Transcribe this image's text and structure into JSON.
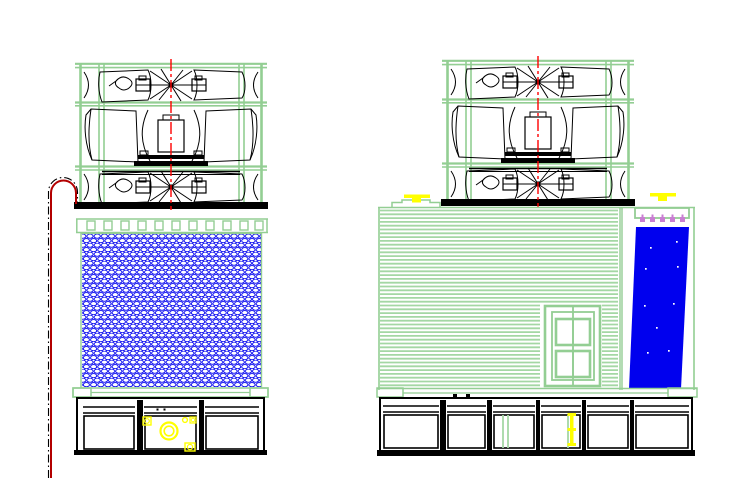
{
  "colors": {
    "green": "#93ce93",
    "louver": "#a4d7a4",
    "blue": "#0000ee",
    "red": "#ff0000",
    "pipe": "#b30000",
    "yellow": "#ffff00",
    "purple": "#c97fd2",
    "black": "#000000",
    "bg": "#ffffff"
  },
  "drawing": {
    "views": [
      {
        "id": "front-elevation",
        "fan_tiers": 3,
        "base_bays": 3,
        "fill_hatch": "blue-honeycomb",
        "riser_pipe": "gooseneck-left"
      },
      {
        "id": "side-elevation",
        "fan_tiers": 3,
        "base_bays": 6,
        "cladding": "horizontal-louvers",
        "door_panes": 2,
        "spray_nozzles": 5,
        "water_column": "blue"
      }
    ]
  },
  "left_tower": {
    "eliminator_xs": [
      87,
      104,
      121,
      138,
      155,
      172,
      189,
      206,
      223,
      240,
      255
    ],
    "base": {
      "y": 398,
      "h": 52,
      "band1": 407,
      "band2": 413,
      "inner_y": 416,
      "inner_h": 33,
      "bays": [
        [
          82,
          136
        ],
        [
          143,
          198
        ],
        [
          204,
          260
        ]
      ],
      "mullions": [
        [
          137,
          6
        ],
        [
          199,
          5
        ]
      ]
    },
    "pump": {
      "big": {
        "cx": 169,
        "cy": 431,
        "r_outer": 8.5,
        "r_inner": 5
      },
      "small": [
        {
          "cx": 147,
          "cy": 421,
          "r": 2.5,
          "box": [
            143,
            417,
            8,
            8
          ]
        },
        {
          "cx": 185,
          "cy": 420,
          "r": 2.5,
          "box": null
        },
        {
          "cx": 193,
          "cy": 420,
          "r": 2,
          "box": [
            190,
            417,
            6,
            6
          ]
        },
        {
          "cx": 190,
          "cy": 447,
          "r": 3,
          "box": [
            185,
            443,
            10,
            8
          ]
        }
      ],
      "dots": [
        [
          157,
          409
        ],
        [
          164,
          409
        ]
      ]
    }
  },
  "right_tower": {
    "louvers": {
      "x1": 380,
      "x2": 618,
      "y1": 210.5,
      "y2": 386,
      "step": 3.8
    },
    "base": {
      "y": 398,
      "h": 52,
      "band1": 406,
      "band2": 412,
      "inner_y": 415,
      "inner_h": 33,
      "bays": [
        [
          382,
          440
        ],
        [
          446,
          487
        ],
        [
          492,
          536
        ],
        [
          540,
          582
        ],
        [
          586,
          630
        ],
        [
          634,
          690
        ]
      ],
      "mullions": [
        [
          440,
          6
        ],
        [
          487,
          5
        ],
        [
          536,
          4
        ],
        [
          582,
          4
        ],
        [
          630,
          4
        ]
      ]
    },
    "nozzle_xs": [
      640,
      650,
      660,
      670,
      680
    ],
    "column_dots": [
      [
        650,
        247
      ],
      [
        676,
        241
      ],
      [
        645,
        268
      ],
      [
        677,
        266
      ],
      [
        644,
        305
      ],
      [
        673,
        303
      ],
      [
        656,
        327
      ],
      [
        647,
        352
      ],
      [
        668,
        350
      ]
    ],
    "bay_green_vlines": [
      503,
      508,
      568
    ]
  }
}
